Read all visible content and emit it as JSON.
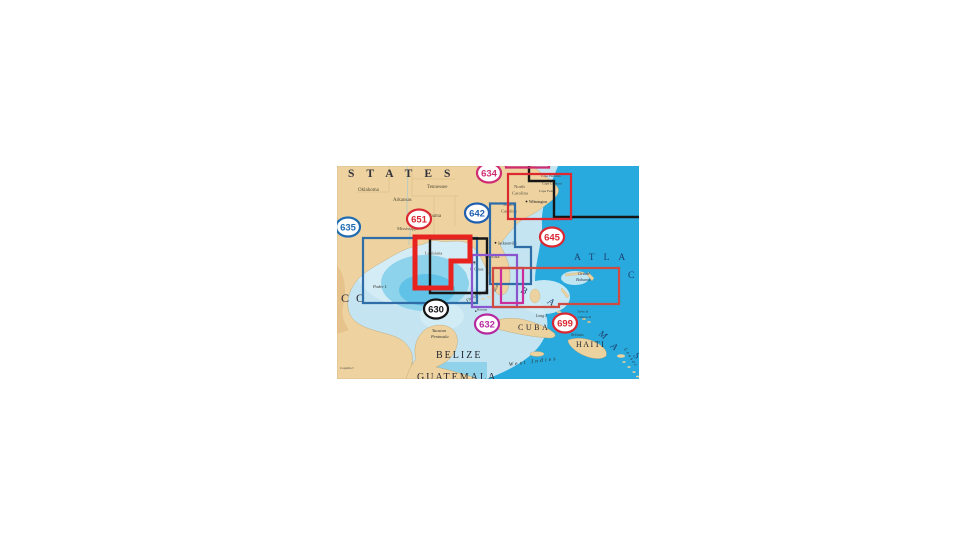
{
  "page": {
    "background": "#ffffff"
  },
  "map": {
    "x": 337,
    "y": 166,
    "width": 302,
    "height": 213,
    "palette": {
      "land": "#eed3a0",
      "land_relief": "#e0b67e",
      "water_shelf": "#c3e4f0",
      "water_pale": "#d4ecf6",
      "water_mid": "#8ed3ec",
      "gulf_deep": "#5fc2e6",
      "ocean_deep": "#28aade",
      "region_blue": "#2e6da8",
      "region_red_thick": "#e8221e",
      "region_black": "#161616",
      "region_purple": "#8a55cf",
      "region_magenta": "#cc2d9d",
      "region_rust": "#cf4a40",
      "region_red": "#dd2731",
      "region_pink": "#cf2d72"
    },
    "badges": [
      {
        "num": "635",
        "x": 11,
        "y": 61,
        "color": "#1f6cb2"
      },
      {
        "num": "651",
        "x": 82,
        "y": 53,
        "color": "#da2732"
      },
      {
        "num": "642",
        "x": 140,
        "y": 47,
        "color": "#1f5fae"
      },
      {
        "num": "634",
        "x": 152,
        "y": 7,
        "color": "#cf2d72"
      },
      {
        "num": "645",
        "x": 215,
        "y": 71,
        "color": "#da2732"
      },
      {
        "num": "630",
        "x": 99,
        "y": 143,
        "color": "#141414"
      },
      {
        "num": "632",
        "x": 150,
        "y": 158,
        "color": "#b62aa0"
      },
      {
        "num": "699",
        "x": 228,
        "y": 157,
        "color": "#da2732"
      }
    ],
    "regions": [
      {
        "id": "635",
        "path": "M26,72 H140 V137 H26 Z",
        "color": "#2e6da8",
        "width": 2.2
      },
      {
        "id": "642",
        "path": "M153,37.5 H178 V81 H194 V118 H153 Z",
        "color": "#2e6da8",
        "width": 2.2
      },
      {
        "id": "630",
        "path": "M93,72.5 H150 V127 H93 Z",
        "color": "#161616",
        "width": 2.4
      },
      {
        "id": "northeast-black",
        "path": "M192,0 V15 H217 V51 H302",
        "color": "#161616",
        "width": 2.4
      },
      {
        "id": "632-purple",
        "path": "M135,89 H180 V141 H135 Z",
        "color": "#8a55cf",
        "width": 2.2
      },
      {
        "id": "632-magenta",
        "path": "M164,102 H186 V137 H164 Z",
        "color": "#cc2d9d",
        "width": 2.2
      },
      {
        "id": "699",
        "path": "M156,102 H282 V138 H222 V141 H156 Z",
        "color": "#cf4a40",
        "width": 2.2
      },
      {
        "id": "645",
        "path": "M171,8 H234 V53 H171 Z",
        "color": "#dd2731",
        "width": 2.2
      },
      {
        "id": "634",
        "path": "M169,-25 H212 V1.5 H169 Z",
        "color": "#cf2d72",
        "width": 2.2
      },
      {
        "id": "651",
        "path": "M78,71 H133 V95 H114 V122 H78 Z",
        "color": "#e8221e",
        "width": 5
      }
    ],
    "city_dots": [
      {
        "x": 158.5,
        "y": 76.8,
        "r": 0.9
      },
      {
        "x": 189.5,
        "y": 35.5,
        "r": 0.9
      },
      {
        "x": 137.2,
        "y": 96.2,
        "r": 0.7
      },
      {
        "x": 138.8,
        "y": 145.2,
        "r": 0.7
      }
    ],
    "labels": [
      {
        "name": "united-states-label",
        "text": "STATES",
        "x": 11,
        "y": 11,
        "size": 11.5,
        "color": "#33333b",
        "spacing": 12,
        "bold": 1
      },
      {
        "name": "mexico-label",
        "text": "CO",
        "x": 4,
        "y": 136,
        "size": 12,
        "color": "#2c2c34",
        "spacing": 7
      },
      {
        "name": "state-oklahoma",
        "text": "Oklahoma",
        "x": 21,
        "y": 25,
        "size": 5,
        "color": "#564c3c"
      },
      {
        "name": "state-arkansas",
        "text": "Arkansas",
        "x": 56,
        "y": 35,
        "size": 5,
        "color": "#564c3c"
      },
      {
        "name": "state-tennessee",
        "text": "Tennessee",
        "x": 90,
        "y": 22,
        "size": 5,
        "color": "#564c3c"
      },
      {
        "name": "state-alabama",
        "text": "Alabama",
        "x": 86,
        "y": 51,
        "size": 5,
        "color": "#564c3c"
      },
      {
        "name": "state-mississippi",
        "text": "Mississippi",
        "x": 60,
        "y": 64,
        "size": 4.6,
        "color": "#564c3c"
      },
      {
        "name": "state-louisiana",
        "text": "Louisiana",
        "x": 88,
        "y": 88.5,
        "size": 4.4,
        "color": "#564c3c"
      },
      {
        "name": "state-north-carolina-1",
        "text": "North",
        "x": 177,
        "y": 22,
        "size": 4.6,
        "color": "#564c3c"
      },
      {
        "name": "state-north-carolina-2",
        "text": "Carolina",
        "x": 175,
        "y": 28.5,
        "size": 4.6,
        "color": "#564c3c"
      },
      {
        "name": "state-south-carolina-1",
        "text": "South",
        "x": 166,
        "y": 40,
        "size": 4.6,
        "color": "#564c3c"
      },
      {
        "name": "state-south-carolina-2",
        "text": "Carolina",
        "x": 164,
        "y": 46.5,
        "size": 4.6,
        "color": "#564c3c"
      },
      {
        "name": "cape-hatteras-label",
        "text": "Cape Hatteras",
        "x": 204,
        "y": 11,
        "size": 3.5,
        "color": "#3c3c3c"
      },
      {
        "name": "cape-lookout-label",
        "text": "Cape Lookout",
        "x": 205,
        "y": 18.5,
        "size": 3.5,
        "color": "#3c3c3c"
      },
      {
        "name": "cape-fear-label",
        "text": "Cape Fear",
        "x": 202,
        "y": 26,
        "size": 3.5,
        "color": "#3c3c3c"
      },
      {
        "name": "city-wilmington",
        "text": "Wilmington",
        "x": 192,
        "y": 37,
        "size": 3.8,
        "color": "#222222"
      },
      {
        "name": "city-jacksonville",
        "text": "Jacksonville",
        "x": 161,
        "y": 78.5,
        "size": 3.8,
        "color": "#222222"
      },
      {
        "name": "state-florida",
        "text": "Florida",
        "x": 148,
        "y": 92,
        "size": 5,
        "color": "#4c4458"
      },
      {
        "name": "city-tampa",
        "text": "Tampa",
        "x": 131,
        "y": 97.5,
        "size": 3.6,
        "color": "#333333"
      },
      {
        "name": "cape-canaveral-label",
        "text": "C. Canav.",
        "x": 133,
        "y": 104.5,
        "size": 3.6,
        "color": "#333333"
      },
      {
        "name": "city-miami",
        "text": "Miami",
        "x": 158.5,
        "y": 126,
        "size": 3.6,
        "color": "#333333",
        "rotate": -68
      },
      {
        "name": "city-havana",
        "text": "Havana",
        "x": 140,
        "y": 144.5,
        "size": 3.3,
        "color": "#333333"
      },
      {
        "name": "florida-keys-label",
        "text": "Florida Keys",
        "x": 130,
        "y": 136,
        "size": 4.3,
        "color": "#2e2e2e",
        "italic": 1,
        "rotate": -27
      },
      {
        "name": "grand-bahama-label-1",
        "text": "Grand",
        "x": 241,
        "y": 109,
        "size": 4.4,
        "color": "#333a55",
        "italic": 1
      },
      {
        "name": "grand-bahama-label-2",
        "text": "Bahama",
        "x": 239,
        "y": 115,
        "size": 4.4,
        "color": "#333a55",
        "italic": 1
      },
      {
        "name": "atlantic-label",
        "text": "ATLA",
        "x": 237,
        "y": 94,
        "size": 9.5,
        "color": "#1d3f6e",
        "spacing": 9
      },
      {
        "name": "ocean-label",
        "text": "C",
        "x": 291,
        "y": 112,
        "size": 9.5,
        "color": "#1d3f6e"
      },
      {
        "name": "bahamas-letter-b",
        "text": "B",
        "x": 183,
        "y": 126,
        "size": 9.5,
        "color": "#1d3f6e",
        "italic": 1,
        "rotate": 25
      },
      {
        "name": "bahamas-letter-a1",
        "text": "A",
        "x": 210,
        "y": 137,
        "size": 9.5,
        "color": "#1d3f6e",
        "italic": 1,
        "rotate": 30
      },
      {
        "name": "bahamas-letter-m",
        "text": "M",
        "x": 261,
        "y": 169,
        "size": 9.5,
        "color": "#1d3f6e",
        "italic": 1,
        "rotate": 35
      },
      {
        "name": "bahamas-letter-a2",
        "text": "A",
        "x": 273,
        "y": 181,
        "size": 9.5,
        "color": "#1d3f6e",
        "italic": 1,
        "rotate": 40
      },
      {
        "name": "bahamas-letter-s",
        "text": "S",
        "x": 296,
        "y": 190,
        "size": 9.5,
        "color": "#1d3f6e",
        "italic": 1,
        "rotate": 45
      },
      {
        "name": "long-island-label",
        "text": "Long I.",
        "x": 199,
        "y": 151,
        "size": 4,
        "color": "#333333",
        "italic": 1
      },
      {
        "name": "turks-label-1",
        "text": "Turks &",
        "x": 240,
        "y": 146.5,
        "size": 3.5,
        "color": "#333333",
        "italic": 1
      },
      {
        "name": "turks-label-2",
        "text": "Caicos Is",
        "x": 241,
        "y": 152,
        "size": 3.5,
        "color": "#333333",
        "italic": 1
      },
      {
        "name": "cuba-label",
        "text": "CUBA",
        "x": 181,
        "y": 164,
        "size": 8,
        "color": "#26262e",
        "spacing": 2.5
      },
      {
        "name": "haiti-label",
        "text": "HAITI",
        "x": 239,
        "y": 181,
        "size": 8,
        "color": "#26262e",
        "spacing": 1.5
      },
      {
        "name": "st-louis-label",
        "text": "St-Louis",
        "x": 234,
        "y": 170,
        "size": 3.8,
        "color": "#333333",
        "italic": 1
      },
      {
        "name": "west-indies-label",
        "text": "West Indies",
        "x": 172,
        "y": 200,
        "size": 5.5,
        "color": "#2a2a2a",
        "italic": 1,
        "spacing": 2.2,
        "rotate": -7
      },
      {
        "name": "belize-label",
        "text": "BELIZE",
        "x": 99,
        "y": 192,
        "size": 10,
        "color": "#26262e",
        "spacing": 2
      },
      {
        "name": "guatemala-label",
        "text": "GUATEMALA",
        "x": 80,
        "y": 214,
        "size": 10,
        "color": "#26262e",
        "spacing": 2
      },
      {
        "name": "yucatan-label-1",
        "text": "Yucatan",
        "x": 95,
        "y": 166,
        "size": 4.4,
        "color": "#333333",
        "italic": 1
      },
      {
        "name": "yucatan-label-2",
        "text": "Peninsula",
        "x": 94,
        "y": 172,
        "size": 4.4,
        "color": "#333333",
        "italic": 1
      },
      {
        "name": "padre-island-label",
        "text": "Padre I.",
        "x": 36,
        "y": 122,
        "size": 4.4,
        "color": "#333333",
        "italic": 1
      },
      {
        "name": "lesser-antilles-label",
        "text": "Lesser",
        "x": 287,
        "y": 183,
        "size": 5,
        "color": "#26323e",
        "italic": 1,
        "spacing": 1.5,
        "rotate": 58
      },
      {
        "name": "copalita-label",
        "text": "Copalita ▪",
        "x": 3,
        "y": 203,
        "size": 3.4,
        "color": "#44403a"
      }
    ]
  }
}
